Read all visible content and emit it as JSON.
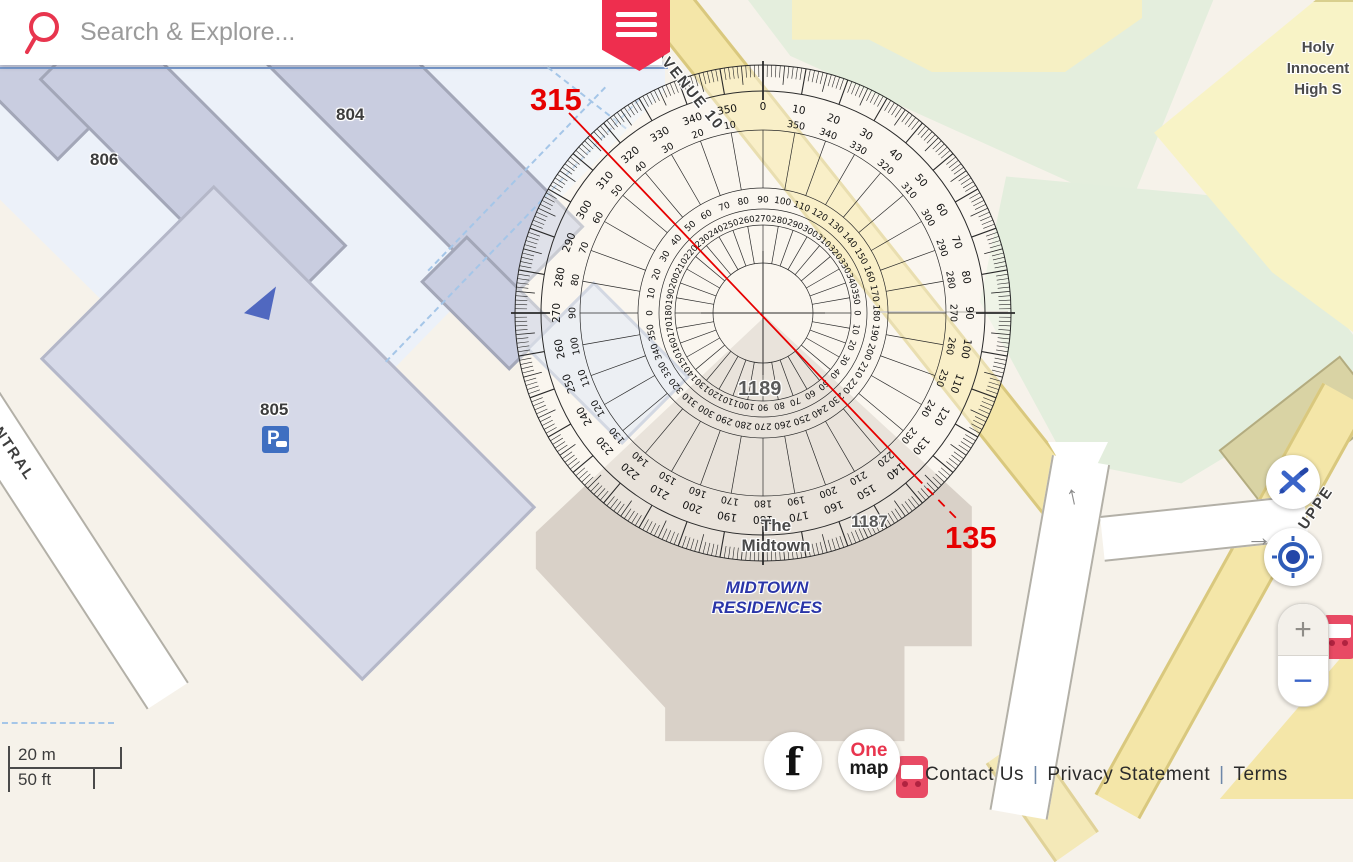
{
  "search": {
    "placeholder": "Search & Explore..."
  },
  "menu": {
    "icon": "hamburger"
  },
  "protractor": {
    "cx": 763,
    "cy": 313,
    "disc_radius": 248,
    "ring_circles": [
      248,
      222,
      183,
      125,
      104,
      88,
      50
    ],
    "tick_band": {
      "deg1_r": 236,
      "deg5_r": 229,
      "deg10_r": 222,
      "cardinal_in": 213,
      "cardinal_out": 252,
      "rim": 248
    },
    "number_scales": [
      {
        "id": "outer-clockwise",
        "radius": 206,
        "direction": "cw",
        "offset": 0,
        "step": 10,
        "font": 10.5
      },
      {
        "id": "outer-counter",
        "radius": 190,
        "direction": "ccw",
        "offset": 0,
        "step": 10,
        "font": 9.5
      },
      {
        "id": "middle",
        "radius": 113,
        "direction": "cw",
        "offset": 90,
        "step": 10,
        "font": 9
      },
      {
        "id": "inner",
        "radius": 94,
        "direction": "cw",
        "offset": 270,
        "step": 10,
        "font": 8.5
      }
    ],
    "spokes": [
      {
        "r1": 125,
        "r2": 183
      },
      {
        "r1": 50,
        "r2": 88
      }
    ],
    "crosshair_r": 62,
    "line_color": "#2a2a2a"
  },
  "bearing": {
    "start_label": "315",
    "end_label": "135",
    "color": "#e60000",
    "solid": [
      569,
      113,
      916,
      477
    ],
    "dashed": [
      916,
      477,
      959,
      521
    ]
  },
  "map": {
    "labels": {
      "b804": "804",
      "b806": "806",
      "b805": "805",
      "b1189": "1189",
      "b1187": "1187",
      "midtown1": "The",
      "midtown2": "Midtown",
      "residences1": "MIDTOWN",
      "residences2": "RESIDENCES",
      "school1": "Holy",
      "school2": "Innocent",
      "school3": "High S",
      "avenue": "G AVENUE 10",
      "central": "NTRAL",
      "upper": "UPPE"
    },
    "residences_color": "#2a35a8",
    "parking_icon": "P"
  },
  "controls": {
    "tools_icon": "pencil-ruler",
    "locate_icon": "target",
    "zoom_in": "+",
    "zoom_out": "−"
  },
  "footer": {
    "facebook": "f",
    "logo_line1": "One",
    "logo_line2": "map",
    "links": {
      "contact": "Contact Us",
      "privacy": "Privacy Statement",
      "terms": "Terms"
    },
    "separator": "|"
  },
  "scalebar": {
    "metric": "20 m",
    "imperial": "50 ft"
  }
}
